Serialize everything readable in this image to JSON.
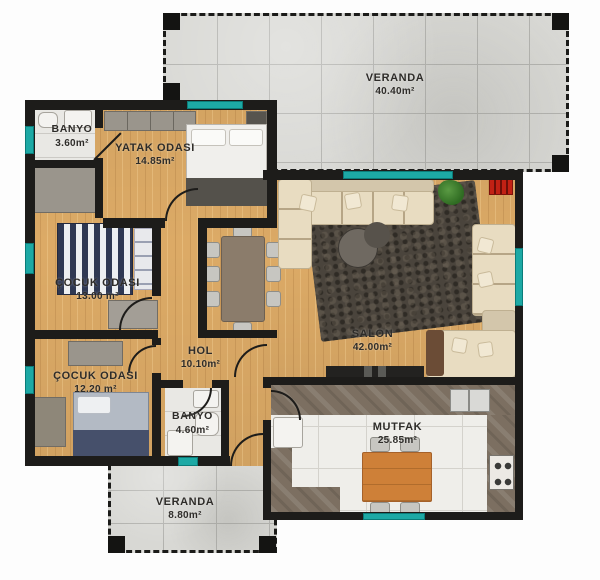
{
  "plan": {
    "type": "apartment-floor-plan",
    "language": "Turkish",
    "rooms": [
      {
        "id": "veranda-top",
        "name": "VERANDA",
        "area": "40.40m²"
      },
      {
        "id": "banyo-top",
        "name": "BANYO",
        "area": "3.60m²"
      },
      {
        "id": "yatak-odasi",
        "name": "YATAK ODASI",
        "area": "14.85m²"
      },
      {
        "id": "cocuk-odasi-1",
        "name": "ÇOCUK ODASI",
        "area": "13.00 m²"
      },
      {
        "id": "hol",
        "name": "HOL",
        "area": "10.10m²"
      },
      {
        "id": "cocuk-odasi-2",
        "name": "ÇOCUK ODASI",
        "area": "12.20 m²"
      },
      {
        "id": "banyo-bottom",
        "name": "BANYO",
        "area": "4.60m²"
      },
      {
        "id": "salon",
        "name": "SALON",
        "area": "42.00m²"
      },
      {
        "id": "mutfak",
        "name": "MUTFAK",
        "area": "25.85m²"
      },
      {
        "id": "veranda-bottom",
        "name": "VERANDA",
        "area": "8.80m²"
      }
    ],
    "colors": {
      "wall": "#1d1c1a",
      "window_marker": "#1da9a5",
      "wood_floor": "#dcaa66",
      "veranda_tile": "#d8d8d4",
      "kitchen_tile": "#efeeea",
      "counter_marble": "#7c6f61",
      "sofa_beige": "#e8dcc1",
      "accent_red": "#c22114",
      "kitchen_table_orange": "#ce8038"
    }
  }
}
